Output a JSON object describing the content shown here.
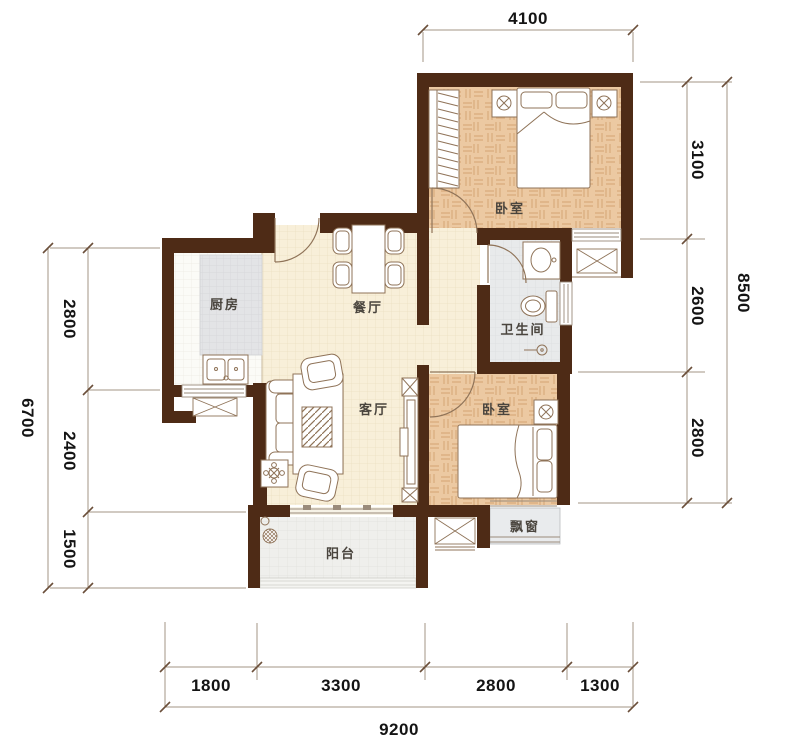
{
  "document": {
    "type_label": "apartment floor plan"
  },
  "rooms": {
    "bedroom_top": {
      "label": "卧室"
    },
    "bedroom_bottom": {
      "label": "卧室"
    },
    "kitchen": {
      "label": "厨房"
    },
    "dining": {
      "label": "餐厅"
    },
    "living": {
      "label": "客厅"
    },
    "bathroom": {
      "label": "卫生间"
    },
    "balcony": {
      "label": "阳台"
    },
    "bay_window": {
      "label": "飘窗"
    }
  },
  "dimensions": {
    "top": {
      "segments": [
        "4100"
      ]
    },
    "right": {
      "segments": [
        "3100",
        "2600",
        "2800"
      ],
      "total": "8500"
    },
    "left": {
      "segments": [
        "2800",
        "2400",
        "1500"
      ],
      "total": "6700"
    },
    "bottom": {
      "segments": [
        "1800",
        "3300",
        "2800",
        "1300"
      ],
      "total": "9200"
    }
  },
  "colors": {
    "wall": "#4e2b16",
    "outline": "#8f7358",
    "dim_line": "#a39584",
    "tick": "#6b4f3a",
    "dim_text": "#141414",
    "room_label": "#4a453e",
    "window_line": "#9a8b7b",
    "parquet": "#ecc9a2",
    "parquet_line": "#d9ab7c",
    "floor_cream": "#f8efd9",
    "floor_cream_line": "#ebdfc1",
    "kitchen_tile": "#e3e4e6",
    "bath_tile": "#e8eaeb",
    "balcony_tile": "#efefec",
    "bay_fill": "#e9ebed"
  }
}
